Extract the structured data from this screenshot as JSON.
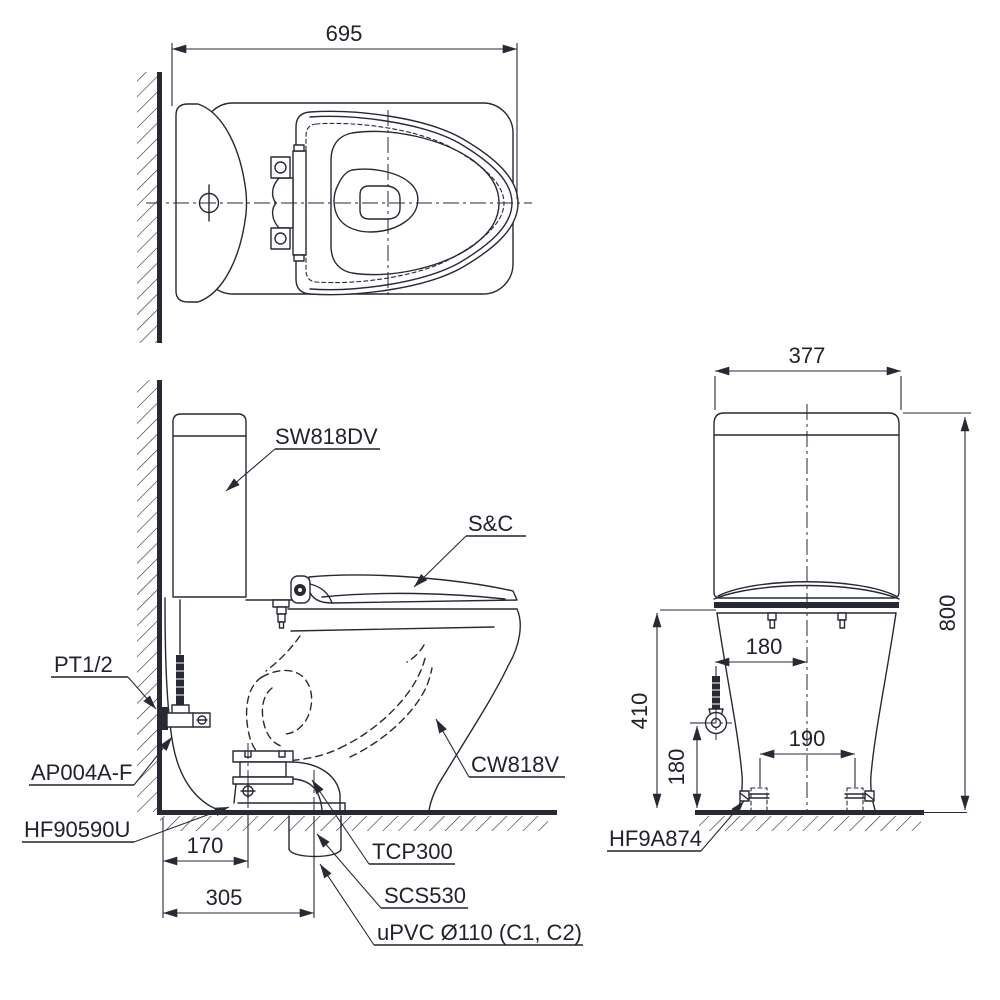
{
  "colors": {
    "ink": "#272935",
    "paper": "#ffffff"
  },
  "top_view": {
    "overall_length": "695"
  },
  "side_view": {
    "tank_model": "SW818DV",
    "seat_model": "S&C",
    "supply_thread": "PT1/2",
    "stop_valve_model": "AP004A-F",
    "flange_model": "HF90590U",
    "bowl_model": "CW818V",
    "adapter_model": "TCP300",
    "socket_model": "SCS530",
    "drain_pipe_spec": "uPVC Ø110 (C1, C2)",
    "flange_setback": "170",
    "rough_in": "305"
  },
  "front_view": {
    "bolt_cap_model": "HF9A874",
    "tank_width": "377",
    "overall_height": "800",
    "rim_height": "410",
    "supply_offset": "180",
    "supply_height": "180",
    "bolt_spacing": "190"
  }
}
